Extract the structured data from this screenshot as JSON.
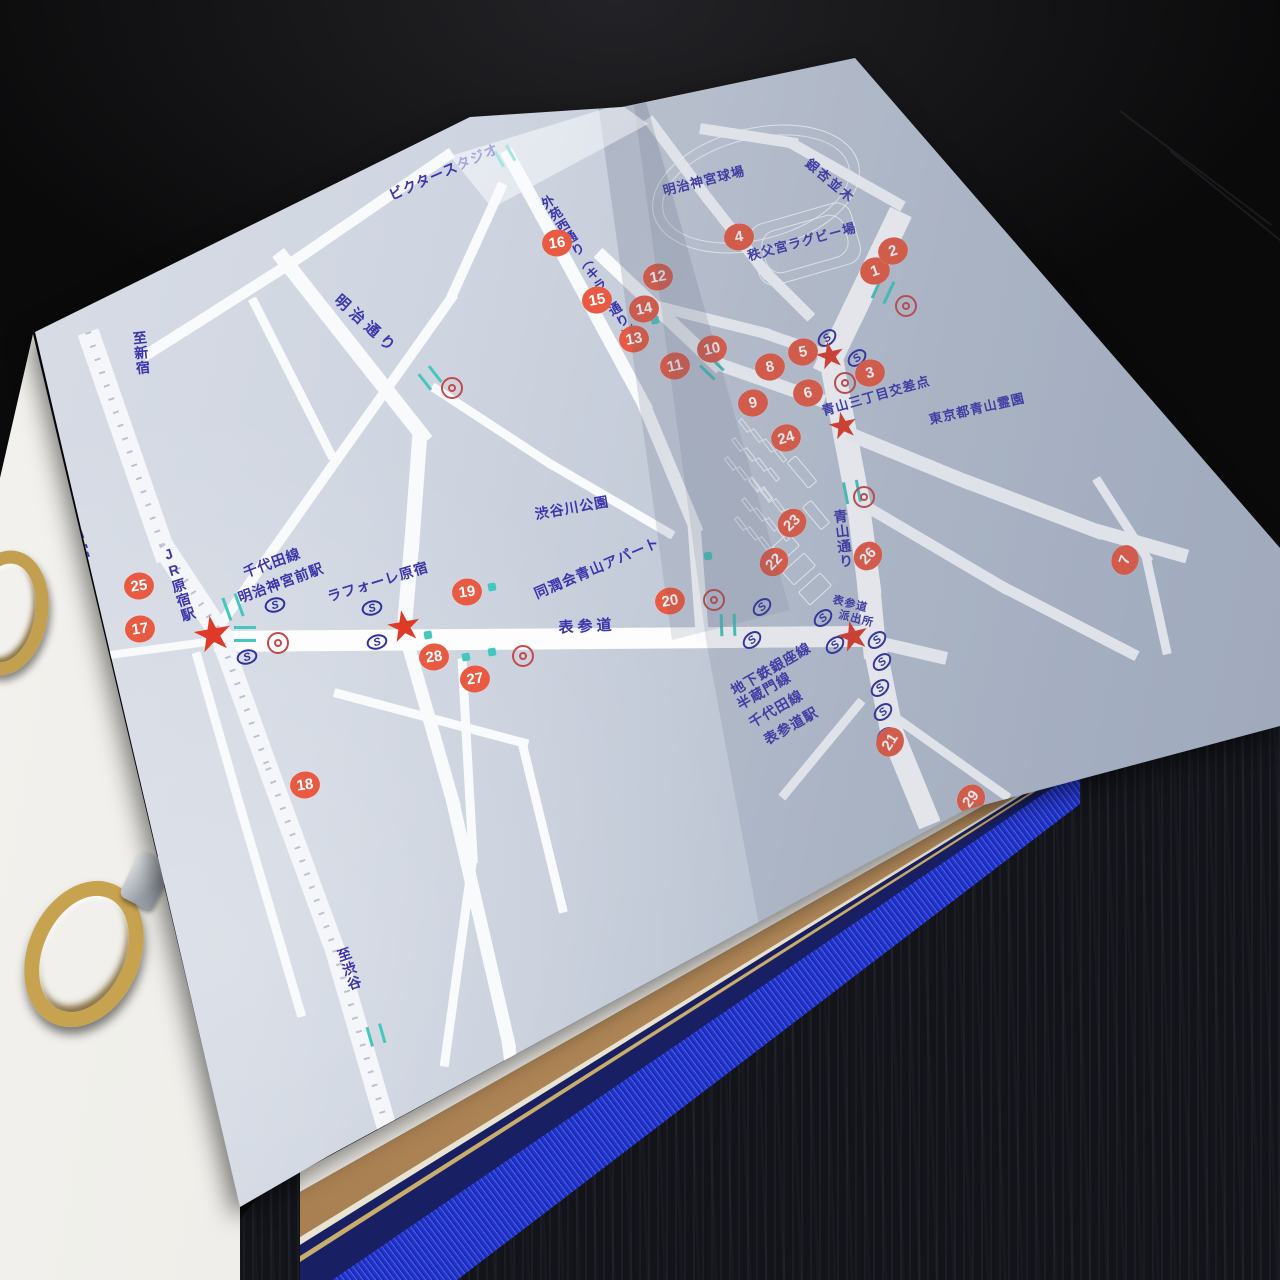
{
  "colors": {
    "label_ink": "#3b35aa",
    "marker_fill": "#e85a42",
    "star_red": "#df3a28",
    "signal_teal": "#44c7bd",
    "subway_ink": "#2e2ea0",
    "entrance_ring_red": "#c64848",
    "paper_blue": "#c6cdda",
    "road_white": "#f8fafc",
    "spine_blue": "#2b3fd0",
    "board_navy": "#182063",
    "page_block_tan": "#b98e60"
  },
  "map": {
    "labels": [
      {
        "t": "ビクタースタジオ",
        "x": 444,
        "y": 172,
        "rot": -24,
        "fs": 14
      },
      {
        "t": "明治神宮球場",
        "x": 704,
        "y": 181,
        "rot": -14,
        "fs": 13
      },
      {
        "t": "銀杏並木",
        "x": 830,
        "y": 181,
        "rot": 40,
        "fs": 13,
        "ls": 2
      },
      {
        "t": "外苑西通り（キラー通り）",
        "x": 588,
        "y": 268,
        "rot": -32,
        "fs": 13,
        "v": true
      },
      {
        "t": "秩父宮ラグビー場",
        "x": 802,
        "y": 242,
        "rot": -15,
        "fs": 13
      },
      {
        "t": "青山三丁目交差点",
        "x": 876,
        "y": 396,
        "rot": -16,
        "fs": 13
      },
      {
        "t": "東京都青山霊園",
        "x": 977,
        "y": 409,
        "rot": -13,
        "fs": 13
      },
      {
        "t": "明治神宮",
        "x": 73,
        "y": 530,
        "rot": -20,
        "fs": 15,
        "v": true
      },
      {
        "t": "至新宿",
        "x": 141,
        "y": 353,
        "rot": -6,
        "fs": 14,
        "v": true
      },
      {
        "t": "明治通り",
        "x": 366,
        "y": 325,
        "rot": 42,
        "fs": 15,
        "ls": 5
      },
      {
        "t": "JR原宿駅",
        "x": 178,
        "y": 584,
        "rot": -18,
        "fs": 14,
        "v": true
      },
      {
        "t": "千代田線",
        "x": 272,
        "y": 563,
        "rot": -20,
        "fs": 14
      },
      {
        "t": "明治神宮前駅",
        "x": 281,
        "y": 583,
        "rot": -20,
        "fs": 14
      },
      {
        "t": "ラフォーレ原宿",
        "x": 378,
        "y": 582,
        "rot": -17,
        "fs": 14
      },
      {
        "t": "渋谷川公園",
        "x": 572,
        "y": 508,
        "rot": -10,
        "fs": 14
      },
      {
        "t": "同潤会青山アパート",
        "x": 597,
        "y": 568,
        "rot": -23,
        "fs": 14
      },
      {
        "t": "表参道",
        "x": 587,
        "y": 627,
        "rot": -3,
        "fs": 15,
        "ls": 4
      },
      {
        "t": "青山通り",
        "x": 843,
        "y": 539,
        "rot": -7,
        "fs": 14,
        "v": true
      },
      {
        "t": "地下鉄銀座線",
        "x": 771,
        "y": 669,
        "rot": -30,
        "fs": 14
      },
      {
        "t": "半蔵門線",
        "x": 764,
        "y": 691,
        "rot": -30,
        "fs": 14
      },
      {
        "t": "千代田線",
        "x": 776,
        "y": 709,
        "rot": -30,
        "fs": 14
      },
      {
        "t": "表参道駅",
        "x": 791,
        "y": 726,
        "rot": -30,
        "fs": 14
      },
      {
        "t": "表参道",
        "x": 850,
        "y": 605,
        "rot": 14,
        "fs": 11
      },
      {
        "t": "派出所",
        "x": 856,
        "y": 620,
        "rot": 14,
        "fs": 11
      },
      {
        "t": "至渋谷",
        "x": 349,
        "y": 969,
        "rot": -19,
        "fs": 14,
        "v": true
      }
    ],
    "markers": [
      {
        "n": "1",
        "x": 875,
        "y": 271,
        "rot": -18
      },
      {
        "n": "2",
        "x": 893,
        "y": 251,
        "rot": -18
      },
      {
        "n": "3",
        "x": 870,
        "y": 373,
        "rot": -14
      },
      {
        "n": "4",
        "x": 739,
        "y": 237,
        "rot": -10
      },
      {
        "n": "5",
        "x": 803,
        "y": 352,
        "rot": -12
      },
      {
        "n": "6",
        "x": 808,
        "y": 393,
        "rot": -14
      },
      {
        "n": "7",
        "x": 1125,
        "y": 560,
        "rot": -70
      },
      {
        "n": "8",
        "x": 770,
        "y": 367,
        "rot": -12
      },
      {
        "n": "9",
        "x": 753,
        "y": 403,
        "rot": -12
      },
      {
        "n": "10",
        "x": 712,
        "y": 349,
        "rot": -12
      },
      {
        "n": "11",
        "x": 675,
        "y": 366,
        "rot": -12
      },
      {
        "n": "12",
        "x": 658,
        "y": 277,
        "rot": -10
      },
      {
        "n": "13",
        "x": 634,
        "y": 339,
        "rot": -10
      },
      {
        "n": "14",
        "x": 644,
        "y": 309,
        "rot": -10
      },
      {
        "n": "15",
        "x": 597,
        "y": 300,
        "rot": -10
      },
      {
        "n": "16",
        "x": 557,
        "y": 243,
        "rot": -8
      },
      {
        "n": "17",
        "x": 140,
        "y": 629,
        "rot": -8
      },
      {
        "n": "18",
        "x": 305,
        "y": 785,
        "rot": -8
      },
      {
        "n": "19",
        "x": 467,
        "y": 592,
        "rot": -8
      },
      {
        "n": "20",
        "x": 670,
        "y": 601,
        "rot": -10
      },
      {
        "n": "21",
        "x": 890,
        "y": 742,
        "rot": -58
      },
      {
        "n": "22",
        "x": 774,
        "y": 562,
        "rot": -46
      },
      {
        "n": "23",
        "x": 792,
        "y": 523,
        "rot": -44
      },
      {
        "n": "24",
        "x": 786,
        "y": 438,
        "rot": -16
      },
      {
        "n": "25",
        "x": 139,
        "y": 586,
        "rot": -8
      },
      {
        "n": "26",
        "x": 868,
        "y": 556,
        "rot": -48
      },
      {
        "n": "27",
        "x": 475,
        "y": 679,
        "rot": -8
      },
      {
        "n": "28",
        "x": 434,
        "y": 657,
        "rot": -8
      },
      {
        "n": "29",
        "x": 971,
        "y": 799,
        "rot": -52
      }
    ],
    "stars": [
      {
        "x": 213,
        "y": 637,
        "s": 48,
        "rot": -10
      },
      {
        "x": 404,
        "y": 628,
        "s": 42,
        "rot": -10
      },
      {
        "x": 830,
        "y": 357,
        "s": 36,
        "rot": -12
      },
      {
        "x": 843,
        "y": 427,
        "s": 36,
        "rot": -12
      },
      {
        "x": 853,
        "y": 638,
        "s": 40,
        "rot": -14
      }
    ],
    "subway_glyph": "S",
    "subway_marks": [
      {
        "x": 275,
        "y": 605,
        "rot": -15
      },
      {
        "x": 247,
        "y": 657,
        "rot": -15
      },
      {
        "x": 372,
        "y": 608,
        "rot": -15
      },
      {
        "x": 377,
        "y": 642,
        "rot": -15
      },
      {
        "x": 827,
        "y": 338,
        "rot": -40
      },
      {
        "x": 857,
        "y": 358,
        "rot": -40
      },
      {
        "x": 762,
        "y": 607,
        "rot": -42
      },
      {
        "x": 823,
        "y": 618,
        "rot": -42
      },
      {
        "x": 752,
        "y": 640,
        "rot": -42
      },
      {
        "x": 835,
        "y": 645,
        "rot": -42
      },
      {
        "x": 877,
        "y": 640,
        "rot": -42
      },
      {
        "x": 882,
        "y": 662,
        "rot": -42
      },
      {
        "x": 880,
        "y": 688,
        "rot": -42
      },
      {
        "x": 883,
        "y": 712,
        "rot": -42
      },
      {
        "x": 886,
        "y": 736,
        "rot": -42
      }
    ],
    "entrance_rings": [
      {
        "x": 452,
        "y": 388
      },
      {
        "x": 278,
        "y": 643
      },
      {
        "x": 523,
        "y": 656
      },
      {
        "x": 714,
        "y": 600
      },
      {
        "x": 845,
        "y": 383
      },
      {
        "x": 906,
        "y": 306
      },
      {
        "x": 864,
        "y": 497
      }
    ],
    "signal_bridges": [
      {
        "x": 430,
        "y": 378,
        "rot": 52,
        "len": 20
      },
      {
        "x": 883,
        "y": 290,
        "rot": 115,
        "len": 24
      },
      {
        "x": 852,
        "y": 492,
        "rot": 79,
        "len": 22
      },
      {
        "x": 712,
        "y": 368,
        "rot": 44,
        "len": 20
      },
      {
        "x": 505,
        "y": 156,
        "rot": 61,
        "len": 18
      },
      {
        "x": 376,
        "y": 1035,
        "rot": 74,
        "len": 20
      },
      {
        "x": 728,
        "y": 625,
        "rot": 88,
        "len": 22
      },
      {
        "x": 233,
        "y": 607,
        "rot": 70,
        "len": 24
      },
      {
        "x": 245,
        "y": 634,
        "rot": 0,
        "len": 22
      }
    ],
    "signal_dots": [
      {
        "x": 655,
        "y": 320
      },
      {
        "x": 492,
        "y": 587
      },
      {
        "x": 428,
        "y": 635
      },
      {
        "x": 466,
        "y": 657
      },
      {
        "x": 492,
        "y": 652
      },
      {
        "x": 976,
        "y": 818
      },
      {
        "x": 708,
        "y": 556
      }
    ],
    "rails": [
      [
        88,
        332,
        162,
        545,
        22
      ],
      [
        162,
        545,
        218,
        630,
        22
      ],
      [
        218,
        630,
        268,
        768,
        20
      ],
      [
        268,
        768,
        335,
        950,
        20
      ],
      [
        335,
        950,
        432,
        1282,
        20
      ]
    ],
    "roads": [
      [
        278,
        252,
        420,
        432,
        15,
        ""
      ],
      [
        420,
        432,
        412,
        540,
        15,
        ""
      ],
      [
        412,
        540,
        404,
        630,
        15,
        ""
      ],
      [
        404,
        630,
        452,
        798,
        13,
        ""
      ],
      [
        452,
        798,
        508,
        1040,
        13,
        ""
      ],
      [
        508,
        1040,
        540,
        1282,
        13,
        ""
      ],
      [
        58,
        662,
        214,
        641,
        8,
        ""
      ],
      [
        214,
        641,
        856,
        636,
        21,
        "major"
      ],
      [
        856,
        637,
        938,
        656,
        13,
        ""
      ],
      [
        218,
        628,
        340,
        455,
        10,
        ""
      ],
      [
        340,
        455,
        450,
        300,
        10,
        ""
      ],
      [
        450,
        300,
        500,
        190,
        10,
        ""
      ],
      [
        452,
        152,
        292,
        262,
        11,
        ""
      ],
      [
        292,
        262,
        150,
        352,
        11,
        ""
      ],
      [
        252,
        298,
        330,
        452,
        9,
        ""
      ],
      [
        432,
        386,
        548,
        462,
        9,
        ""
      ],
      [
        548,
        462,
        668,
        532,
        9,
        ""
      ],
      [
        334,
        692,
        522,
        742,
        9,
        ""
      ],
      [
        462,
        658,
        473,
        856,
        9,
        ""
      ],
      [
        473,
        856,
        445,
        1060,
        9,
        ""
      ],
      [
        522,
        742,
        562,
        906,
        9,
        ""
      ],
      [
        196,
        652,
        240,
        806,
        9,
        ""
      ],
      [
        240,
        806,
        300,
        1010,
        9,
        ""
      ],
      [
        506,
        150,
        578,
        282,
        13,
        ""
      ],
      [
        578,
        282,
        643,
        402,
        13,
        ""
      ],
      [
        643,
        402,
        694,
        524,
        13,
        ""
      ],
      [
        694,
        524,
        702,
        632,
        13,
        ""
      ],
      [
        598,
        252,
        714,
        362,
        13,
        ""
      ],
      [
        714,
        362,
        816,
        398,
        13,
        ""
      ],
      [
        658,
        306,
        762,
        332,
        11,
        ""
      ],
      [
        762,
        332,
        826,
        354,
        11,
        ""
      ],
      [
        648,
        118,
        706,
        196,
        11,
        ""
      ],
      [
        706,
        196,
        764,
        270,
        11,
        ""
      ],
      [
        764,
        270,
        806,
        312,
        11,
        ""
      ],
      [
        700,
        128,
        790,
        142,
        11,
        ""
      ],
      [
        790,
        142,
        896,
        202,
        11,
        ""
      ],
      [
        901,
        212,
        858,
        302,
        24,
        "major"
      ],
      [
        858,
        302,
        831,
        358,
        24,
        "major"
      ],
      [
        831,
        358,
        844,
        428,
        24,
        "major"
      ],
      [
        844,
        428,
        858,
        502,
        24,
        "major"
      ],
      [
        858,
        502,
        868,
        578,
        23,
        "major"
      ],
      [
        868,
        578,
        874,
        642,
        23,
        "major"
      ],
      [
        874,
        642,
        892,
        732,
        23,
        "major"
      ],
      [
        892,
        732,
        924,
        810,
        23,
        "major"
      ],
      [
        847,
        433,
        962,
        480,
        14,
        ""
      ],
      [
        962,
        480,
        1094,
        530,
        14,
        ""
      ],
      [
        1094,
        530,
        1178,
        554,
        14,
        ""
      ],
      [
        1096,
        478,
        1146,
        556,
        9,
        ""
      ],
      [
        1146,
        556,
        1166,
        648,
        9,
        ""
      ],
      [
        856,
        500,
        1002,
        586,
        11,
        ""
      ],
      [
        1002,
        586,
        1130,
        652,
        11,
        ""
      ],
      [
        862,
        700,
        786,
        792,
        9,
        ""
      ],
      [
        880,
        706,
        1004,
        794,
        9,
        ""
      ]
    ],
    "buildings": [
      {
        "x": 650,
        "y": 128,
        "w": 212,
        "h": 122,
        "rot": -14,
        "r": "50%",
        "dbl": true
      },
      {
        "x": 752,
        "y": 212,
        "w": 106,
        "h": 64,
        "rot": -16,
        "r": "16px",
        "dbl": true
      },
      {
        "x": 768,
        "y": 540,
        "w": 30,
        "h": 18,
        "rot": -42,
        "r": "2px"
      },
      {
        "x": 784,
        "y": 560,
        "w": 30,
        "h": 18,
        "rot": -42,
        "r": "2px"
      },
      {
        "x": 800,
        "y": 580,
        "w": 30,
        "h": 18,
        "rot": -42,
        "r": "2px"
      },
      {
        "x": 796,
        "y": 455,
        "w": 12,
        "h": 34,
        "rot": -40,
        "r": "2px"
      },
      {
        "x": 810,
        "y": 500,
        "w": 12,
        "h": 30,
        "rot": -40,
        "r": "2px"
      }
    ],
    "tick_clusters": [
      {
        "x": 742,
        "y": 418,
        "rows": 3,
        "cols": 4,
        "cdx": 12,
        "cdy": 10,
        "rdx": -7,
        "rdy": 19,
        "tw": 5,
        "th": 15,
        "rot": -38
      },
      {
        "x": 752,
        "y": 478,
        "rows": 3,
        "cols": 4,
        "cdx": 12,
        "cdy": 10,
        "rdx": -7,
        "rdy": 19,
        "tw": 5,
        "th": 15,
        "rot": -38
      }
    ]
  }
}
